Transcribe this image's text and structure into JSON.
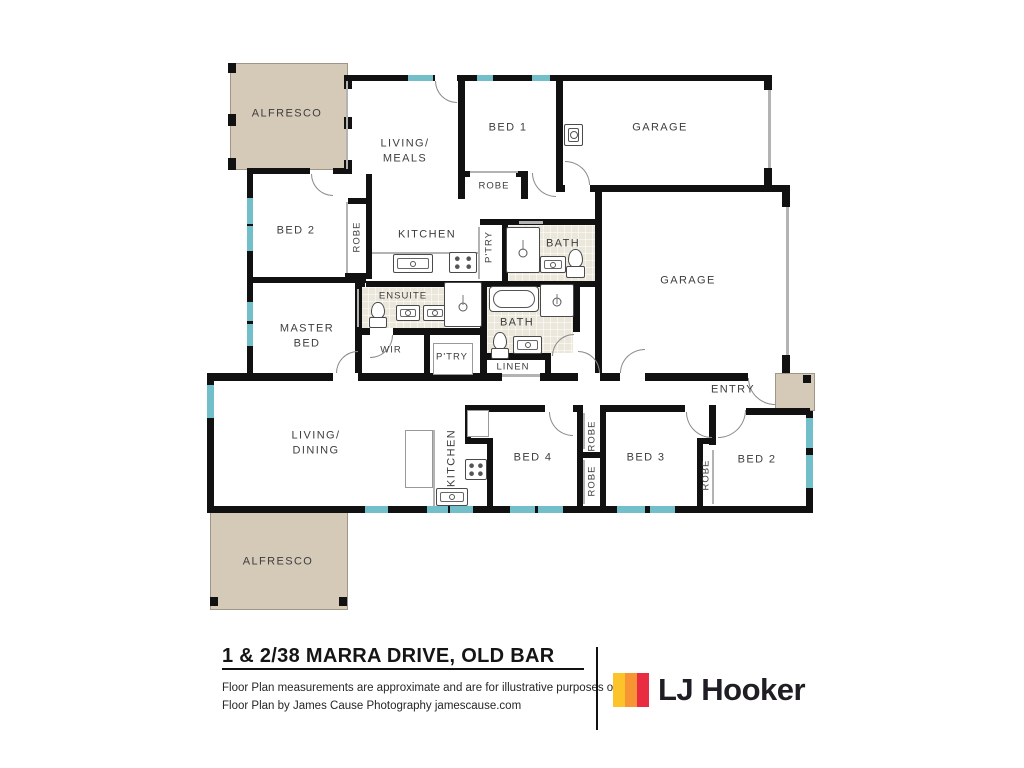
{
  "footer": {
    "address": "1 & 2/38 MARRA DRIVE, OLD BAR",
    "disclaimer_line1": "Floor Plan measurements are approximate and are for illustrative purposes only.",
    "disclaimer_line2": "Floor Plan by James Cause Photography jamescause.com",
    "brand": {
      "name": "LJ Hooker",
      "logo_colors": [
        "#FCC32B",
        "#F79433",
        "#E92C41"
      ]
    }
  },
  "floorplan": {
    "colors": {
      "wall": "#111111",
      "window": "#72bfca",
      "outdoor": "#d5c9b8",
      "tile": "#ece7db",
      "label": "#3d3d3d"
    },
    "rooms": [
      {
        "label": "ALFRESCO",
        "x": 287,
        "y": 114
      },
      {
        "label": "LIVING/\nMEALS",
        "x": 405,
        "y": 152
      },
      {
        "label": "BED 1",
        "x": 508,
        "y": 128
      },
      {
        "label": "ROBE",
        "x": 494,
        "y": 186,
        "small": true
      },
      {
        "label": "GARAGE",
        "x": 660,
        "y": 128
      },
      {
        "label": "BED 2",
        "x": 296,
        "y": 231
      },
      {
        "label": "ROBE",
        "x": 357,
        "y": 237,
        "rot": true,
        "small": true
      },
      {
        "label": "KITCHEN",
        "x": 427,
        "y": 235
      },
      {
        "label": "P'TRY",
        "x": 489,
        "y": 247,
        "rot": true,
        "small": true
      },
      {
        "label": "BATH",
        "x": 563,
        "y": 244
      },
      {
        "label": "GARAGE",
        "x": 688,
        "y": 281
      },
      {
        "label": "ENSUITE",
        "x": 403,
        "y": 296,
        "small": true
      },
      {
        "label": "MASTER\nBED",
        "x": 307,
        "y": 337
      },
      {
        "label": "WIR",
        "x": 391,
        "y": 350,
        "small": true
      },
      {
        "label": "P'TRY",
        "x": 452,
        "y": 357,
        "small": true
      },
      {
        "label": "BATH",
        "x": 517,
        "y": 323
      },
      {
        "label": "LINEN",
        "x": 513,
        "y": 367,
        "small": true
      },
      {
        "label": "ENTRY",
        "x": 733,
        "y": 390
      },
      {
        "label": "LIVING/\nDINING",
        "x": 316,
        "y": 444
      },
      {
        "label": "KITCHEN",
        "x": 452,
        "y": 458,
        "rot": true
      },
      {
        "label": "BED 4",
        "x": 533,
        "y": 458
      },
      {
        "label": "ROBE",
        "x": 592,
        "y": 436,
        "rot": true,
        "small": true
      },
      {
        "label": "ROBE",
        "x": 592,
        "y": 481,
        "rot": true,
        "small": true
      },
      {
        "label": "BED 3",
        "x": 646,
        "y": 458
      },
      {
        "label": "ROBE",
        "x": 706,
        "y": 475,
        "rot": true,
        "small": true
      },
      {
        "label": "BED 2",
        "x": 757,
        "y": 460
      },
      {
        "label": "ALFRESCO",
        "x": 278,
        "y": 562
      }
    ],
    "outdoor_areas": [
      {
        "name": "alfresco-top",
        "rect": [
          230,
          63,
          118,
          107
        ]
      },
      {
        "name": "alfresco-bottom",
        "rect": [
          210,
          512,
          138,
          98
        ]
      },
      {
        "name": "entry-porch",
        "rect": [
          775,
          373,
          40,
          38
        ]
      }
    ],
    "tile_areas": [
      {
        "name": "bath-top",
        "rect": [
          508,
          225,
          87,
          56
        ]
      },
      {
        "name": "ensuite",
        "rect": [
          361,
          287,
          84,
          41
        ]
      },
      {
        "name": "bath-mid",
        "rect": [
          487,
          287,
          86,
          66
        ]
      }
    ],
    "walls": [
      [
        348,
        75,
        87,
        6
      ],
      [
        457,
        75,
        315,
        6
      ],
      [
        344,
        75,
        8,
        14
      ],
      [
        344,
        117,
        8,
        12
      ],
      [
        344,
        160,
        8,
        14
      ],
      [
        247,
        168,
        6,
        210
      ],
      [
        247,
        168,
        63,
        6
      ],
      [
        333,
        168,
        15,
        6
      ],
      [
        366,
        174,
        6,
        105
      ],
      [
        348,
        198,
        18,
        6
      ],
      [
        345,
        273,
        21,
        6
      ],
      [
        247,
        277,
        119,
        6
      ],
      [
        355,
        283,
        7,
        90
      ],
      [
        207,
        373,
        126,
        8
      ],
      [
        358,
        373,
        144,
        8
      ],
      [
        540,
        373,
        38,
        8
      ],
      [
        600,
        373,
        20,
        8
      ],
      [
        645,
        373,
        103,
        8
      ],
      [
        458,
        81,
        7,
        90
      ],
      [
        458,
        171,
        12,
        6
      ],
      [
        516,
        171,
        12,
        6
      ],
      [
        458,
        177,
        7,
        22
      ],
      [
        521,
        177,
        7,
        22
      ],
      [
        556,
        75,
        7,
        110
      ],
      [
        556,
        185,
        9,
        7
      ],
      [
        590,
        185,
        200,
        7
      ],
      [
        764,
        75,
        8,
        15
      ],
      [
        764,
        168,
        8,
        17
      ],
      [
        782,
        192,
        8,
        15
      ],
      [
        782,
        355,
        8,
        18
      ],
      [
        595,
        192,
        7,
        181
      ],
      [
        366,
        281,
        236,
        6
      ],
      [
        480,
        219,
        122,
        6
      ],
      [
        502,
        225,
        6,
        56
      ],
      [
        355,
        281,
        10,
        6
      ],
      [
        355,
        328,
        15,
        7
      ],
      [
        393,
        328,
        89,
        7
      ],
      [
        424,
        335,
        6,
        38
      ],
      [
        480,
        281,
        7,
        72
      ],
      [
        480,
        353,
        7,
        20
      ],
      [
        487,
        353,
        58,
        7
      ],
      [
        545,
        353,
        6,
        20
      ],
      [
        573,
        281,
        7,
        51
      ],
      [
        207,
        378,
        7,
        134
      ],
      [
        207,
        506,
        606,
        7
      ],
      [
        465,
        405,
        80,
        7
      ],
      [
        573,
        405,
        10,
        7
      ],
      [
        577,
        405,
        6,
        108
      ],
      [
        600,
        405,
        6,
        108
      ],
      [
        577,
        452,
        29,
        6
      ],
      [
        465,
        405,
        6,
        38
      ],
      [
        465,
        438,
        28,
        6
      ],
      [
        487,
        438,
        6,
        75
      ],
      [
        606,
        405,
        79,
        7
      ],
      [
        709,
        405,
        7,
        40
      ],
      [
        697,
        438,
        12,
        6
      ],
      [
        697,
        443,
        6,
        70
      ],
      [
        746,
        408,
        64,
        7
      ],
      [
        806,
        411,
        7,
        102
      ]
    ],
    "windows": [
      [
        408,
        75,
        25,
        6
      ],
      [
        477,
        75,
        16,
        6
      ],
      [
        532,
        75,
        18,
        6
      ],
      [
        247,
        198,
        6,
        26
      ],
      [
        247,
        226,
        6,
        25
      ],
      [
        247,
        302,
        6,
        19
      ],
      [
        247,
        324,
        6,
        22
      ],
      [
        207,
        385,
        7,
        33
      ],
      [
        365,
        506,
        23,
        7
      ],
      [
        427,
        506,
        21,
        7
      ],
      [
        450,
        506,
        23,
        7
      ],
      [
        510,
        506,
        25,
        7
      ],
      [
        538,
        506,
        25,
        7
      ],
      [
        617,
        506,
        28,
        7
      ],
      [
        650,
        506,
        25,
        7
      ],
      [
        806,
        418,
        7,
        30
      ],
      [
        806,
        455,
        7,
        33
      ]
    ],
    "thin_lines": [
      [
        346,
        81,
        2,
        88
      ],
      [
        346,
        202,
        2,
        71
      ],
      [
        470,
        171,
        48,
        2
      ],
      [
        478,
        227,
        2,
        52
      ],
      [
        519,
        221,
        24,
        3
      ],
      [
        357,
        289,
        2,
        38
      ],
      [
        502,
        374,
        38,
        3
      ],
      [
        768,
        90,
        3,
        78
      ],
      [
        786,
        207,
        3,
        148
      ],
      [
        372,
        252,
        106,
        2
      ],
      [
        433,
        430,
        2,
        76
      ],
      [
        583,
        413,
        2,
        36
      ],
      [
        583,
        460,
        2,
        44
      ],
      [
        712,
        450,
        2,
        54
      ]
    ],
    "outline_boxes": [
      {
        "name": "pantry-shelf",
        "rect": [
          433,
          343,
          40,
          32
        ]
      },
      {
        "name": "kitchen-island",
        "rect": [
          405,
          430,
          28,
          58
        ]
      },
      {
        "name": "fridge-space",
        "rect": [
          467,
          410,
          22,
          27
        ]
      }
    ],
    "fixtures": [
      {
        "type": "sink",
        "rect": [
          393,
          254,
          40,
          19
        ]
      },
      {
        "type": "cooktop",
        "rect": [
          449,
          252,
          28,
          21
        ]
      },
      {
        "type": "sink",
        "rect": [
          540,
          256,
          26,
          17
        ]
      },
      {
        "type": "toilet",
        "rect": [
          566,
          249,
          19,
          29
        ]
      },
      {
        "type": "shower",
        "rect": [
          506,
          227,
          34,
          46
        ]
      },
      {
        "type": "toilet",
        "rect": [
          369,
          302,
          18,
          26
        ]
      },
      {
        "type": "sink",
        "rect": [
          396,
          305,
          24,
          16
        ]
      },
      {
        "type": "sink",
        "rect": [
          423,
          305,
          24,
          16
        ]
      },
      {
        "type": "shower",
        "rect": [
          444,
          282,
          38,
          45
        ]
      },
      {
        "type": "bathtub",
        "rect": [
          489,
          286,
          50,
          26
        ]
      },
      {
        "type": "shower",
        "rect": [
          540,
          284,
          34,
          33
        ]
      },
      {
        "type": "toilet",
        "rect": [
          491,
          332,
          18,
          27
        ]
      },
      {
        "type": "sink",
        "rect": [
          513,
          336,
          29,
          18
        ]
      },
      {
        "type": "tub",
        "rect": [
          564,
          124,
          19,
          22
        ]
      },
      {
        "type": "cooktop",
        "rect": [
          465,
          459,
          22,
          21
        ]
      },
      {
        "type": "sink",
        "rect": [
          436,
          488,
          32,
          18
        ]
      }
    ],
    "door_arcs": [
      {
        "dir": "bl",
        "rect": [
          435,
          81,
          22,
          22
        ]
      },
      {
        "dir": "bl",
        "rect": [
          311,
          174,
          22,
          22
        ]
      },
      {
        "dir": "tl",
        "rect": [
          336,
          351,
          22,
          22
        ]
      },
      {
        "dir": "br",
        "rect": [
          370,
          335,
          23,
          23
        ]
      },
      {
        "dir": "tl",
        "rect": [
          552,
          334,
          22,
          22
        ]
      },
      {
        "dir": "bl",
        "rect": [
          532,
          173,
          24,
          24
        ]
      },
      {
        "dir": "tr",
        "rect": [
          565,
          161,
          25,
          24
        ]
      },
      {
        "dir": "tr",
        "rect": [
          578,
          351,
          22,
          22
        ]
      },
      {
        "dir": "tl",
        "rect": [
          620,
          349,
          25,
          24
        ]
      },
      {
        "dir": "bl",
        "rect": [
          748,
          378,
          27,
          27
        ]
      },
      {
        "dir": "bl",
        "rect": [
          549,
          412,
          24,
          24
        ]
      },
      {
        "dir": "bl",
        "rect": [
          686,
          412,
          26,
          26
        ]
      },
      {
        "dir": "br",
        "rect": [
          718,
          410,
          28,
          28
        ]
      }
    ],
    "corner_posts": [
      [
        228,
        63,
        8,
        10
      ],
      [
        228,
        114,
        8,
        12
      ],
      [
        228,
        158,
        8,
        12
      ],
      [
        210,
        597,
        8,
        9
      ],
      [
        339,
        597,
        8,
        9
      ],
      [
        803,
        375,
        8,
        8
      ]
    ]
  }
}
